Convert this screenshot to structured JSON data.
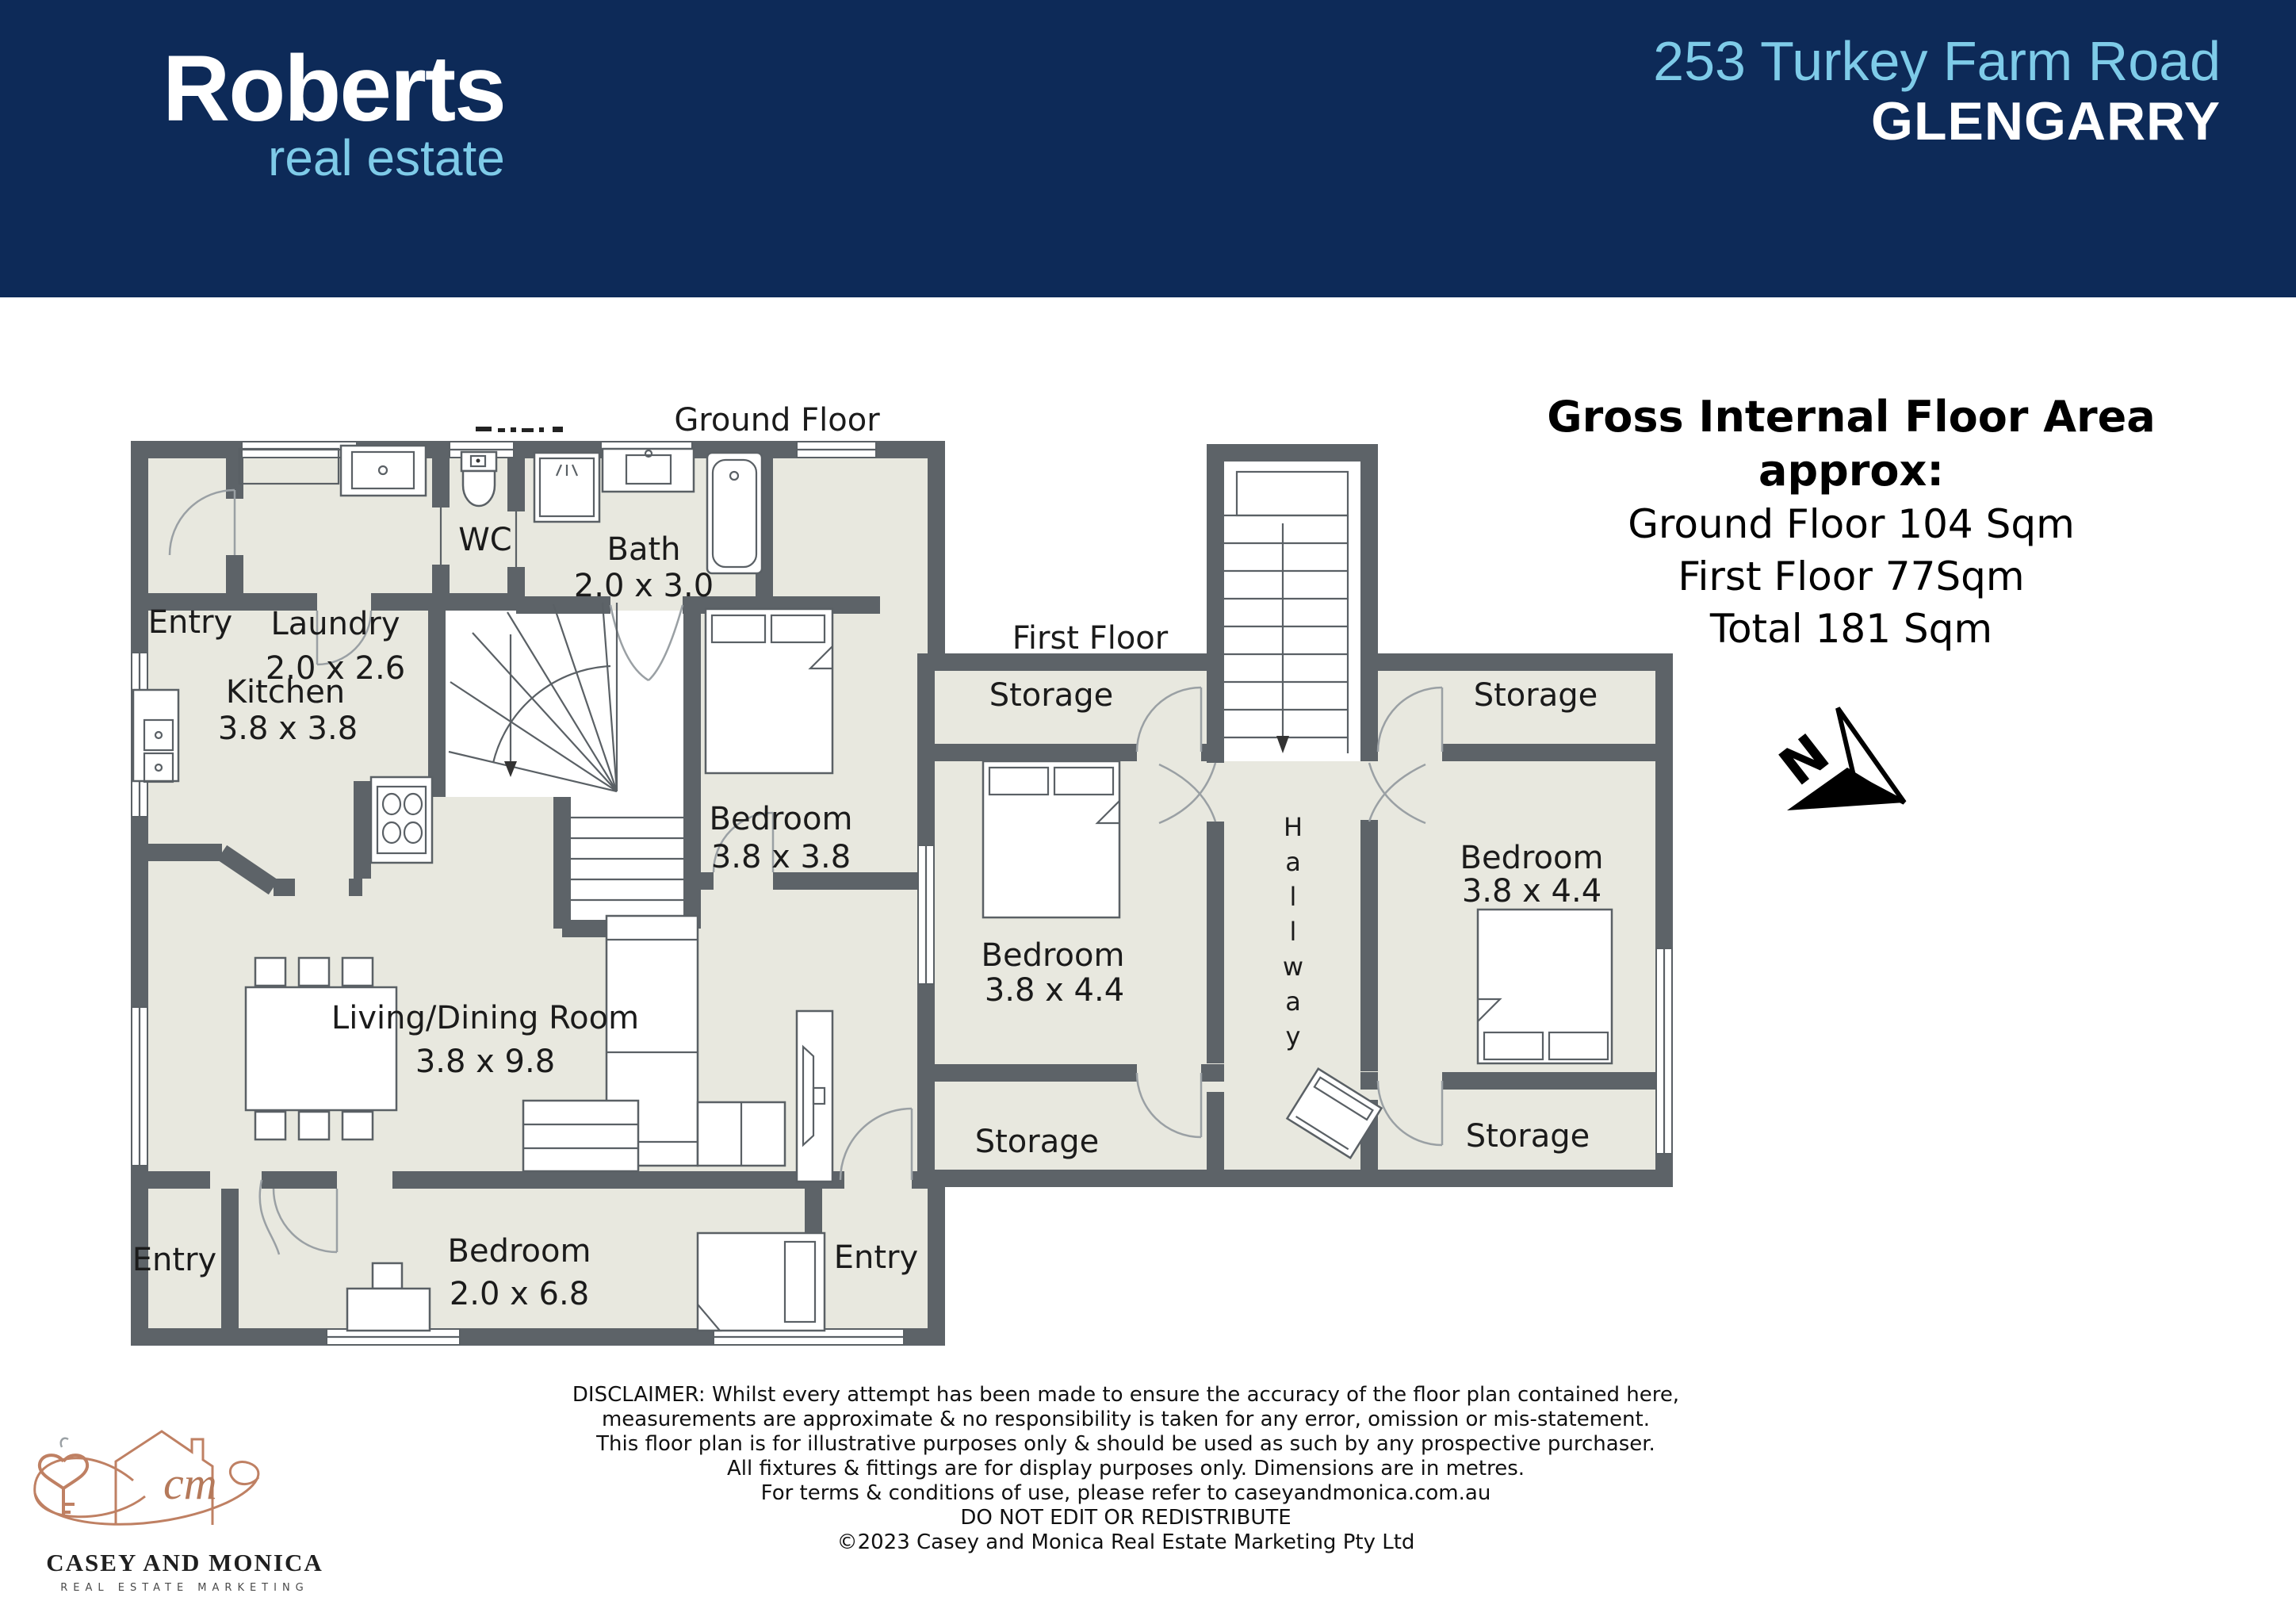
{
  "header": {
    "brand": {
      "name": "Roberts",
      "tagline": "real estate"
    },
    "address_line1": "253 Turkey Farm Road",
    "address_line2": "GLENGARRY"
  },
  "floor_area": {
    "title": "Gross Internal Floor Area approx:",
    "lines": [
      "Ground Floor 104 Sqm",
      "First Floor 77Sqm",
      "Total 181 Sqm"
    ]
  },
  "ground_floor": {
    "title": "Ground Floor",
    "rooms": [
      {
        "name": "Entry"
      },
      {
        "name": "Laundry",
        "dims": "2.0 x 2.6"
      },
      {
        "name": "WC"
      },
      {
        "name": "Bath",
        "dims": "2.0 x 3.0"
      },
      {
        "name": "Kitchen",
        "dims": "3.8 x 3.8"
      },
      {
        "name": "Bedroom",
        "dims": "3.8 x 3.8"
      },
      {
        "name": "Living/Dining Room",
        "dims": "3.8 x 9.8"
      },
      {
        "name": "Entry"
      },
      {
        "name": "Bedroom",
        "dims": "2.0 x 6.8"
      },
      {
        "name": "Entry"
      }
    ]
  },
  "first_floor": {
    "title": "First Floor",
    "hallway": "Hallway",
    "rooms": [
      {
        "name": "Storage"
      },
      {
        "name": "Storage"
      },
      {
        "name": "Bedroom",
        "dims": "3.8 x 4.4"
      },
      {
        "name": "Bedroom",
        "dims": "3.8 x 4.4"
      },
      {
        "name": "Storage"
      },
      {
        "name": "Storage"
      }
    ]
  },
  "north_indicator": "N",
  "disclaimer": {
    "lines": [
      "DISCLAIMER: Whilst every attempt has been made to ensure the accuracy of the floor plan contained here,",
      "measurements are approximate & no responsibility is taken for any error, omission or mis-statement.",
      "This floor plan is for illustrative purposes only & should be used as such by any prospective purchaser.",
      "All fixtures & fittings are for display purposes only. Dimensions are in metres.",
      "For terms & conditions of use, please refer to caseyandmonica.com.au",
      "DO NOT EDIT OR REDISTRIBUTE",
      "©2023 Casey and Monica Real Estate Marketing Pty Ltd"
    ]
  },
  "agency_logo": {
    "initials": "cm",
    "name": "CASEY AND MONICA",
    "tagline": "REAL ESTATE MARKETING"
  },
  "colors": {
    "header_navy": "#0d2a58",
    "light_blue": "#7ecbe8",
    "wall_gray": "#5d6368",
    "floor_fill": "#e8e8df",
    "logo_copper": "#bf8063"
  }
}
